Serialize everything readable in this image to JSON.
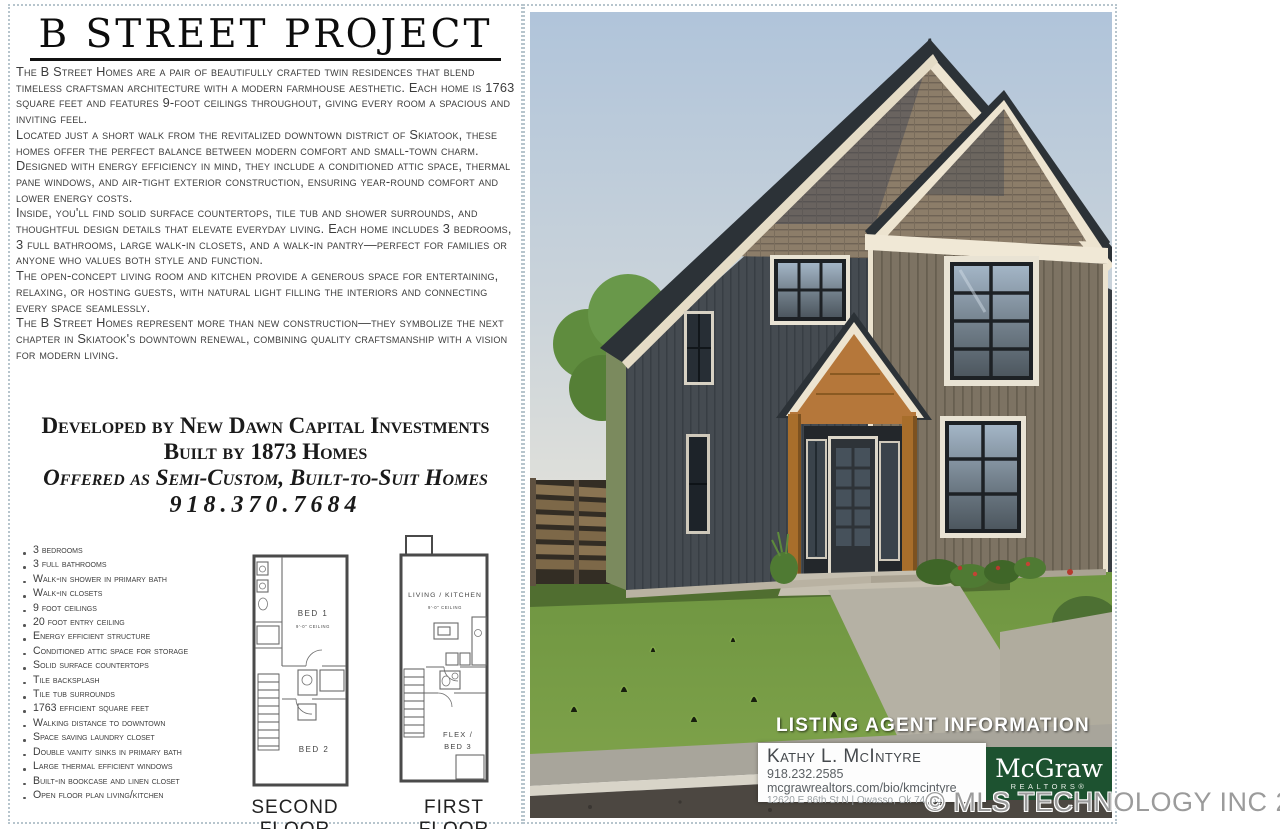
{
  "flyer": {
    "title": "B STREET PROJECT",
    "paragraphs": [
      "The B Street Homes are a pair of beautifully crafted twin residences that blend timeless craftsman architecture with a modern farmhouse aesthetic. Each home is 1763 square feet and features 9-foot ceilings throughout, giving every room a spacious and inviting feel.",
      "Located just a short walk from the revitalized downtown district of Skiatook, these homes offer the perfect balance between modern comfort and small-town charm. Designed with energy efficiency in mind, they include a conditioned attic space, thermal pane windows, and air-tight exterior construction, ensuring year-round comfort and lower energy costs.",
      "Inside, you'll find solid surface countertops, tile tub and shower surrounds, and thoughtful design details that elevate everyday living. Each home includes 3 bedrooms, 3 full bathrooms, large walk-in closets, and a walk-in pantry—perfect for families or anyone who values both style and function.",
      "The open-concept living room and kitchen provide a generous space for entertaining, relaxing, or hosting guests, with natural light filling the interiors and connecting every space seamlessly.",
      "The B Street Homes represent more than new construction—they symbolize the next chapter in Skiatook's downtown renewal, combining quality craftsmanship with a vision for modern living."
    ],
    "developer_line": "Developed by New Dawn Capital Investments",
    "builder_line": "Built by 1873 Homes",
    "offer_line": "Offered as Semi-Custom, Built-to-Suit Homes",
    "phone": "918.370.7684",
    "features": [
      "3 bedrooms",
      "3 full bathrooms",
      "Walk-in shower in primary bath",
      "Walk-in closets",
      "9 foot ceilings",
      "20 foot entry ceiling",
      "Energy efficient structure",
      "Conditioned attic space for storage",
      "Solid surface countertops",
      "Tile backsplash",
      "Tile tub surrounds",
      "1763 efficient square feet",
      "Walking distance to downtown",
      "Space saving laundry closet",
      "Double vanity sinks in primary bath",
      "Large thermal efficient windows",
      "Built-in bookcase and linen closet",
      "Open floor plan living/kitchen"
    ],
    "floorplans": {
      "second": {
        "caption": "SECOND FLOOR",
        "bed1": "BED 1",
        "ceiling": "9'-0\" CEILING",
        "bed2": "BED 2"
      },
      "first": {
        "caption": "FIRST FLOOR",
        "living": "LIVING / KITCHEN",
        "ceiling": "9'-0\" CEILING",
        "flex1": "FLEX /",
        "flex2": "BED 3"
      }
    }
  },
  "listing_agent": {
    "header": "LISTING AGENT INFORMATION",
    "name": "Kathy L. McIntyre",
    "phone": "918.232.2585",
    "website": "mcgrawrealtors.com/bio/kmcintyre",
    "address": "12620 E 86th St N | Owasso, Ok 74055",
    "brokerage_name": "McGraw",
    "brokerage_subtitle": "REALTORS®"
  },
  "watermark": "© MLS TECHNOLOGY INC 2025",
  "palette": {
    "mcgraw_green": "#1d5230",
    "sky_blue": "#b3c6db",
    "grass_green": "#759c41",
    "trim_cream": "#ede4d0",
    "siding_dark": "#454b51",
    "porch_wood": "#b5773a"
  }
}
